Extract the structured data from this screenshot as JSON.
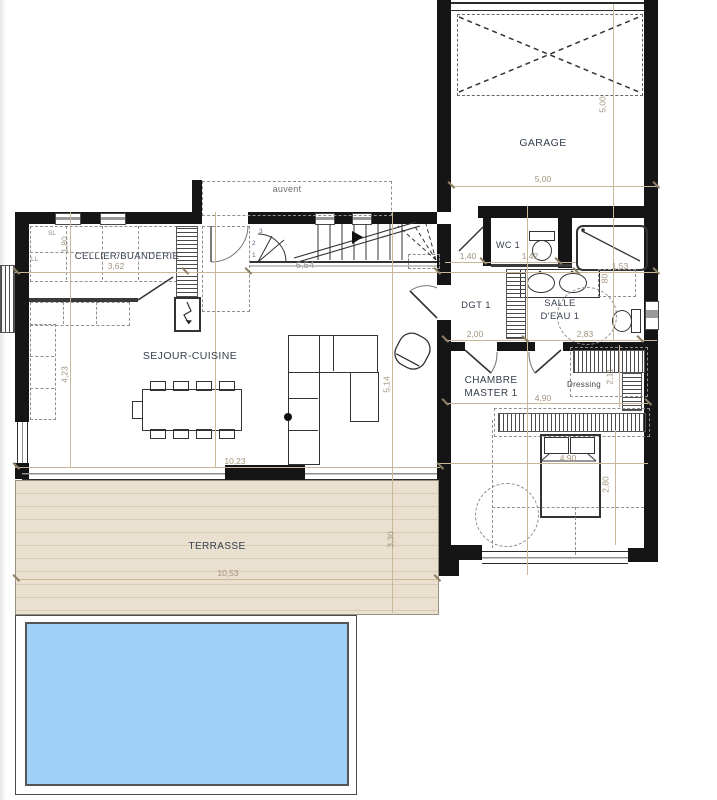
{
  "rooms": {
    "garage": "GARAGE",
    "auvent": "auvent",
    "cellier": "CELLIER/BUANDERIE",
    "wc1": "WC 1",
    "dgt1": "DGT 1",
    "salle_eau_l1": "SALLE",
    "salle_eau_l2": "D'EAU 1",
    "chambre_l1": "CHAMBRE",
    "chambre_l2": "MASTER 1",
    "dressing": "Dressing",
    "sejour": "SEJOUR-CUISINE",
    "terrasse": "TERRASSE"
  },
  "dims": {
    "garage_w": "5,00",
    "garage_h": "5,00",
    "cellier_w": "3,62",
    "cellier_h": "1,80",
    "stair_len": "6,54",
    "wc_a": "1,40",
    "wc_b": "1,42",
    "shower_w": "1,53",
    "dgt_w": "2,00",
    "sde_w": "2,83",
    "chambre_w": "4,90",
    "dressing_h": "2,11",
    "bed_span": "4,90",
    "chambre_h": "2,80",
    "sejour_h1": "4,23",
    "sejour_h2": "5,14",
    "sejour_w": "10,23",
    "terrasse_w": "10,53",
    "terrasse_h": "3,30",
    "shower_niche": "80"
  },
  "labels": {
    "sl": "SL",
    "ll": "LL",
    "step1": "1",
    "step2": "2",
    "step3": "3"
  },
  "colors": {
    "pool": "#9fd0f8",
    "terrace": "#eae0cf",
    "wall": "#151515",
    "dim_line": "#c9b79a",
    "dim_text": "#a2947d",
    "label_text": "#36404e"
  }
}
